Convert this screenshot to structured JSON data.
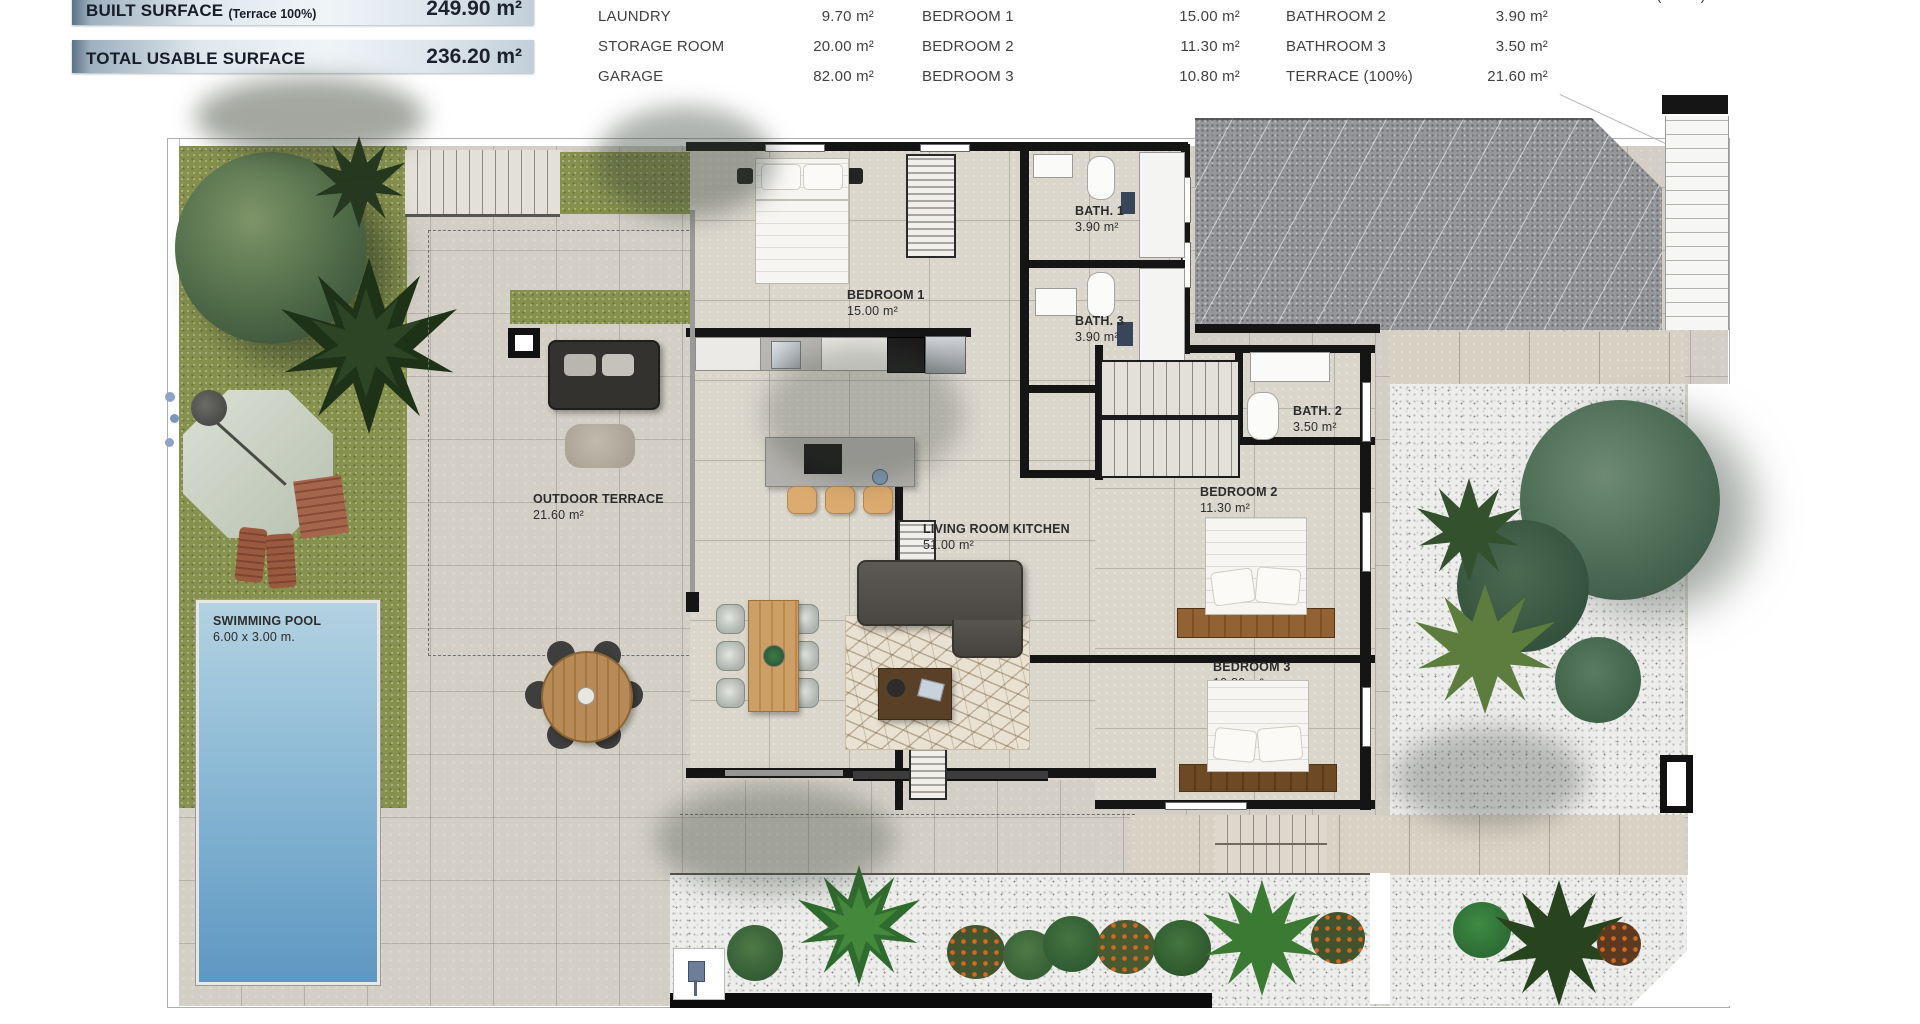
{
  "summary": {
    "built_surface": {
      "label": "BUILT SURFACE",
      "sublabel": "(Terrace 100%)",
      "value": "249.90 m²"
    },
    "total_usable": {
      "label": "TOTAL USABLE SURFACE",
      "value": "236.20 m²"
    }
  },
  "area_table": {
    "columns": [
      {
        "rows": [
          {
            "label": "LAUNDRY",
            "value": "9.70 m²"
          },
          {
            "label": "STORAGE ROOM",
            "value": "20.00 m²"
          },
          {
            "label": "GARAGE",
            "value": "82.00 m²"
          }
        ]
      },
      {
        "rows": [
          {
            "label": "LIVING ROOM KITCHEN",
            "value": "51.00 m²",
            "clipped": true
          },
          {
            "label": "BEDROOM 1",
            "value": "15.00 m²"
          },
          {
            "label": "BEDROOM 2",
            "value": "11.30 m²"
          },
          {
            "label": "BEDROOM 3",
            "value": "10.80 m²"
          }
        ]
      },
      {
        "rows": [
          {
            "label": "BATHROOM 1",
            "value": "3.90 m²",
            "clipped": true
          },
          {
            "label": "BATHROOM 2",
            "value": "3.90 m²"
          },
          {
            "label": "BATHROOM 3",
            "value": "3.50 m²"
          },
          {
            "label": "TERRACE (100%)",
            "value": "21.60 m²"
          }
        ]
      },
      {
        "rows": [
          {
            "label": "SOLARIUM (100%)",
            "value": "70.00 m²",
            "clipped": true
          }
        ]
      }
    ]
  },
  "plan": {
    "rooms": [
      {
        "name": "BEDROOM 1",
        "area": "15.00 m²"
      },
      {
        "name": "BATH. 1",
        "area": "3.90 m²"
      },
      {
        "name": "BATH. 3",
        "area": "3.90 m²"
      },
      {
        "name": "BATH. 2",
        "area": "3.50 m²"
      },
      {
        "name": "BEDROOM 2",
        "area": "11.30 m²"
      },
      {
        "name": "BEDROOM 3",
        "area": "10.80 m²"
      },
      {
        "name": "LIVING ROOM KITCHEN",
        "area": "51.00 m²"
      },
      {
        "name": "OUTDOOR TERRACE",
        "area": "21.60 m²"
      },
      {
        "name": "SWIMMING POOL",
        "area": "6.00 x 3.00 m."
      }
    ]
  },
  "colors": {
    "banner_dark": "#5d7284",
    "banner_light": "#f0f4f7",
    "grass": "#87914e",
    "pool_deep": "#5e97c2",
    "pool_light": "#aecfe0",
    "roof": "#96979a",
    "wall": "#151515",
    "floor": "#d3cfc6",
    "text": "#3d3d3d"
  }
}
